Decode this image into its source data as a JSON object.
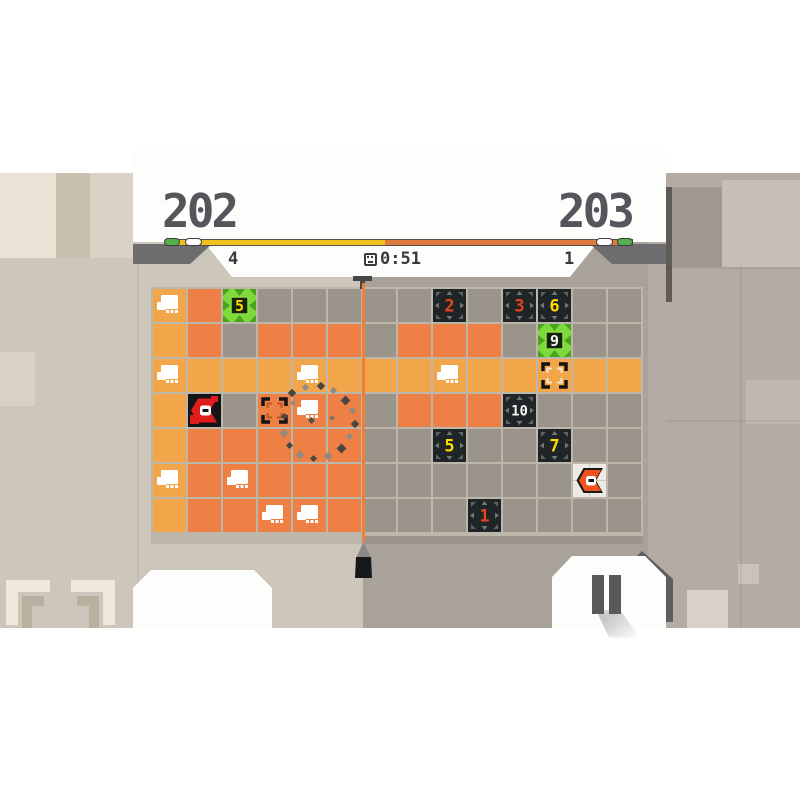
{
  "header": {
    "score_left": "202",
    "score_right": "203",
    "counter_left": "4",
    "counter_right": "1",
    "timer": "0:51",
    "bar": {
      "left_color": "#eec11d",
      "right_color": "#df7a3e",
      "left_fraction": 0.47,
      "pills": [
        "#53b04b",
        "#ffffff",
        "#ffffff",
        "#53b04b"
      ]
    }
  },
  "board": {
    "cols": 14,
    "rows": 7,
    "terrain_colors": {
      "L": "#f3a54a",
      "D": "#ee8045",
      "G": "#9b948b"
    },
    "terrain": [
      "LDGGGGGGGGGGGG",
      "LDGDDDGDDDGGGG",
      "LLLLLLLLLLLLLL",
      "LGGDDDGDDDGGGG",
      "LDDDDDGGGGGGGG",
      "LDDDDDGGGGGGGG",
      "LDDDDDGGGGGGGG"
    ],
    "skulls": [
      [
        0,
        0
      ],
      [
        2,
        0
      ],
      [
        2,
        4
      ],
      [
        2,
        8
      ],
      [
        3,
        4
      ],
      [
        5,
        0
      ],
      [
        5,
        2
      ],
      [
        6,
        3
      ],
      [
        6,
        4
      ]
    ],
    "number_tiles": [
      {
        "row": 0,
        "col": 8,
        "value": "2",
        "color": "#e8431c"
      },
      {
        "row": 0,
        "col": 10,
        "value": "3",
        "color": "#e8431c"
      },
      {
        "row": 0,
        "col": 11,
        "value": "6",
        "color": "#ffd900"
      },
      {
        "row": 3,
        "col": 10,
        "value": "10",
        "color": "#f5f5f5"
      },
      {
        "row": 4,
        "col": 8,
        "value": "5",
        "color": "#ffd900"
      },
      {
        "row": 4,
        "col": 11,
        "value": "7",
        "color": "#ffd900"
      },
      {
        "row": 6,
        "col": 9,
        "value": "1",
        "color": "#e8431c"
      }
    ],
    "green_tiles": [
      {
        "row": 0,
        "col": 2,
        "value": "5",
        "color": "#ffd900"
      },
      {
        "row": 1,
        "col": 11,
        "value": "9",
        "color": "#f5f5f5"
      }
    ],
    "targets": [
      {
        "row": 2,
        "col": 11,
        "inner": "#f3e7ce"
      },
      {
        "row": 3,
        "col": 3,
        "inner": "#b85a22"
      }
    ],
    "players": [
      {
        "name": "player-red",
        "row": 3,
        "col": 1,
        "variant": "dark",
        "chevron": "#e01d1d"
      },
      {
        "name": "player-orange",
        "row": 5,
        "col": 12,
        "variant": "light",
        "chevron": "#f1521e"
      }
    ],
    "divider_color": "#f08034",
    "particles": [
      {
        "x": 289,
        "y": 390,
        "s": 6,
        "c": "#4a463f"
      },
      {
        "x": 303,
        "y": 385,
        "s": 5,
        "c": "#8d8a84"
      },
      {
        "x": 318,
        "y": 383,
        "s": 6,
        "c": "#4a463f"
      },
      {
        "x": 331,
        "y": 388,
        "s": 5,
        "c": "#8d8a84"
      },
      {
        "x": 342,
        "y": 397,
        "s": 7,
        "c": "#4a463f"
      },
      {
        "x": 350,
        "y": 408,
        "s": 5,
        "c": "#8d8a84"
      },
      {
        "x": 352,
        "y": 421,
        "s": 6,
        "c": "#4a463f"
      },
      {
        "x": 347,
        "y": 434,
        "s": 5,
        "c": "#8d8a84"
      },
      {
        "x": 338,
        "y": 445,
        "s": 7,
        "c": "#4a463f"
      },
      {
        "x": 325,
        "y": 453,
        "s": 6,
        "c": "#8d8a84"
      },
      {
        "x": 311,
        "y": 456,
        "s": 5,
        "c": "#4a463f"
      },
      {
        "x": 297,
        "y": 452,
        "s": 6,
        "c": "#8d8a84"
      },
      {
        "x": 287,
        "y": 443,
        "s": 5,
        "c": "#4a463f"
      },
      {
        "x": 281,
        "y": 430,
        "s": 6,
        "c": "#8d8a84"
      },
      {
        "x": 282,
        "y": 414,
        "s": 5,
        "c": "#4a463f"
      },
      {
        "x": 291,
        "y": 401,
        "s": 4,
        "c": "#8d8a84"
      },
      {
        "x": 309,
        "y": 418,
        "s": 5,
        "c": "#55514a"
      },
      {
        "x": 330,
        "y": 416,
        "s": 4,
        "c": "#77736c"
      }
    ]
  }
}
